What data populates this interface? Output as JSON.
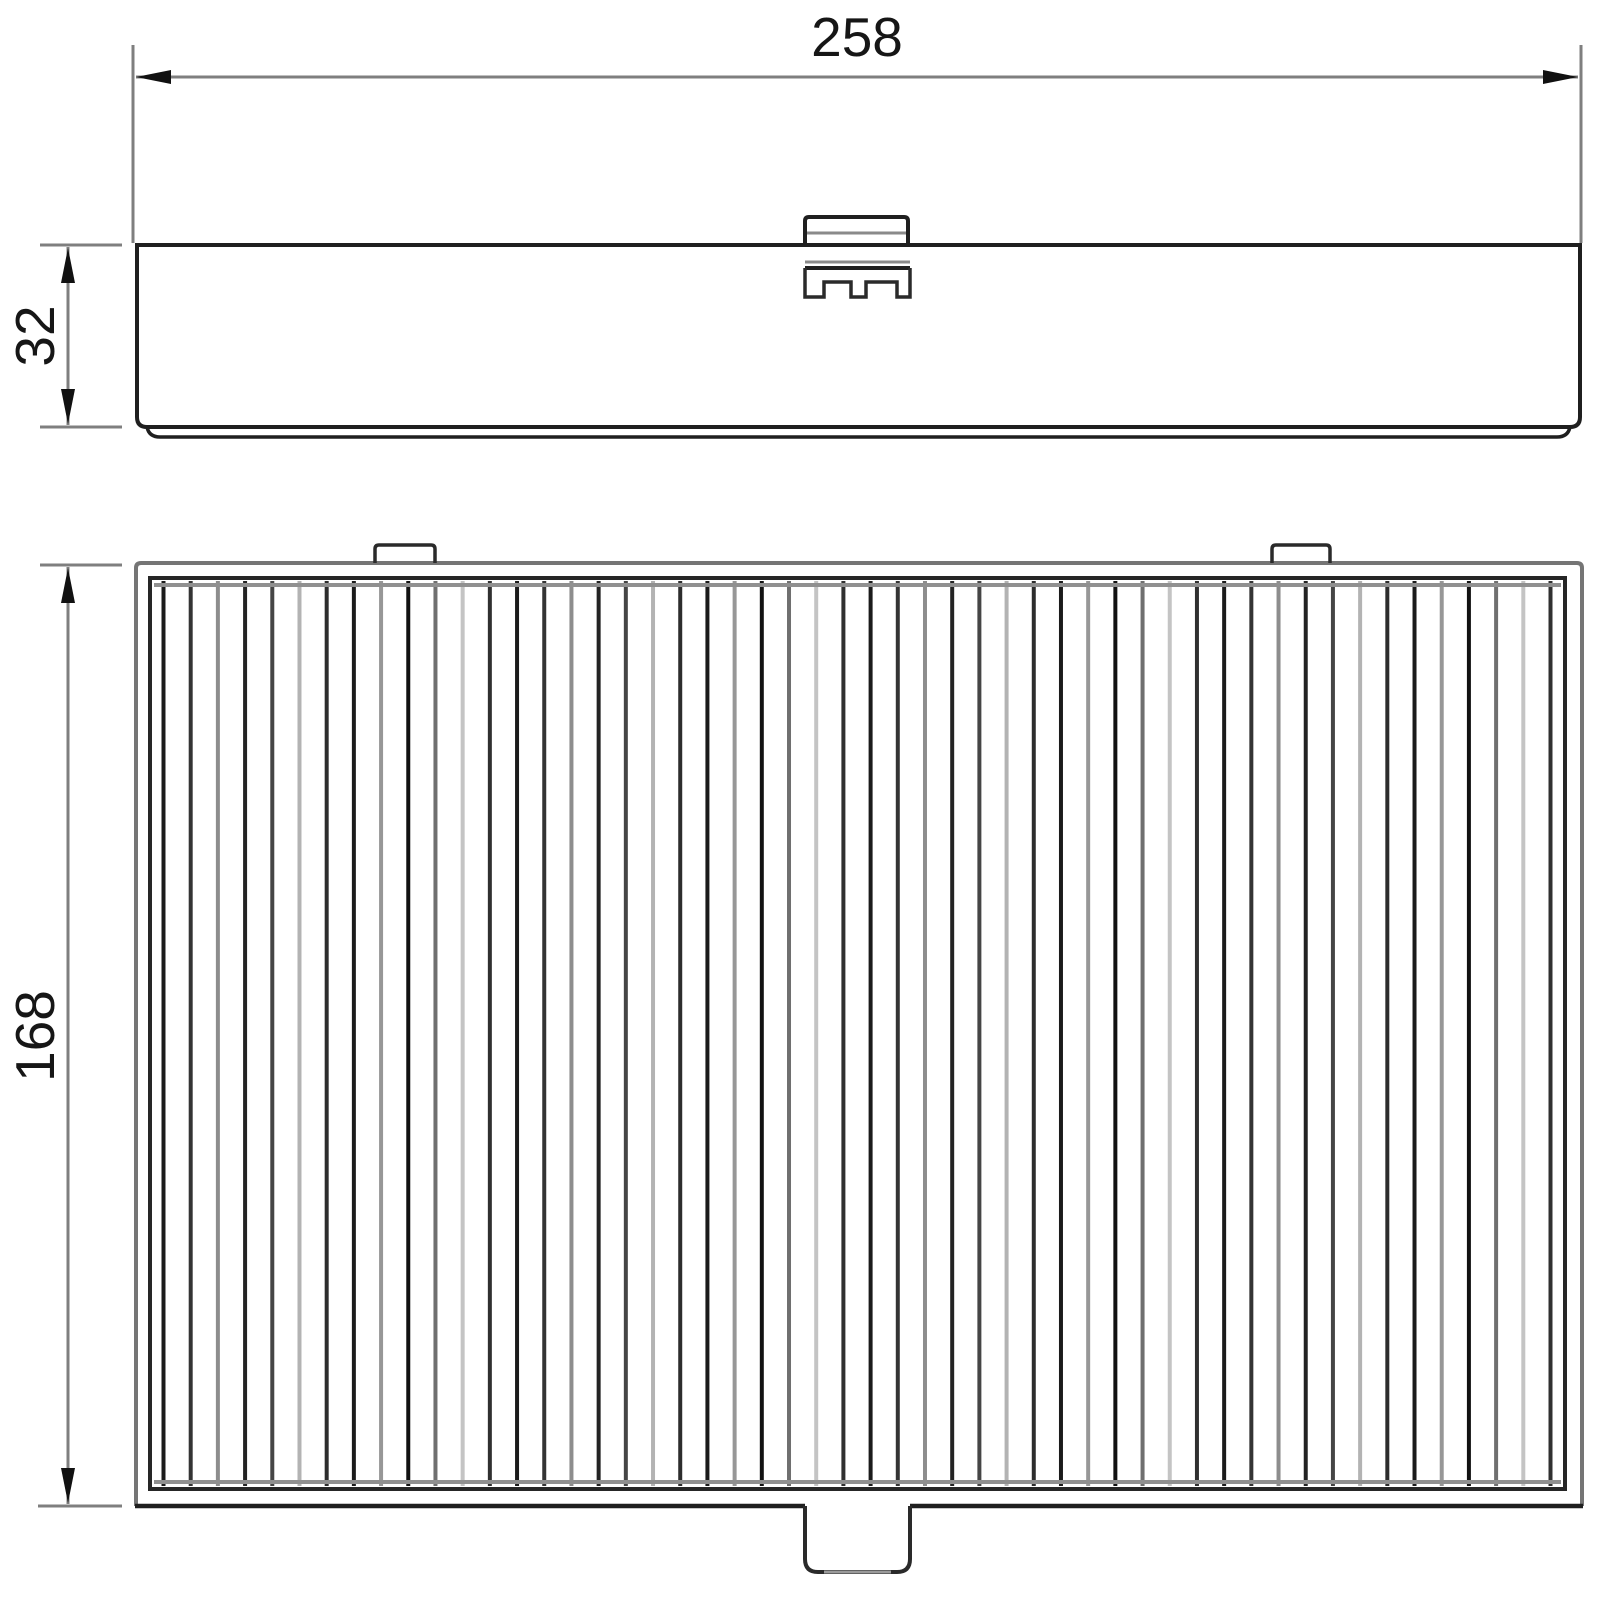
{
  "drawing": {
    "dimensions": {
      "width_label": "258",
      "depth_label": "32",
      "height_label": "168"
    },
    "colors": {
      "outline": "#1f1f1f",
      "detail": "#2a2a2a",
      "dimension": "#7f7f7f",
      "arrow": "#111111",
      "outer_frame": "#757575",
      "inner_frame": "#262626",
      "fold_band": "#909090",
      "lip_gray": "#9a9a9a",
      "tab_inner_gray": "#8a8a8a",
      "background": "#ffffff"
    },
    "pleats": {
      "count": 52,
      "stroke_colors": [
        "#1b1b1b",
        "#343434",
        "#8d8d8d",
        "#232323",
        "#454545",
        "#b3b3b3",
        "#2d2d2d",
        "#1b1b1b",
        "#979797",
        "#111111",
        "#6f6f6f",
        "#c4c4c4",
        "#303030"
      ]
    }
  }
}
